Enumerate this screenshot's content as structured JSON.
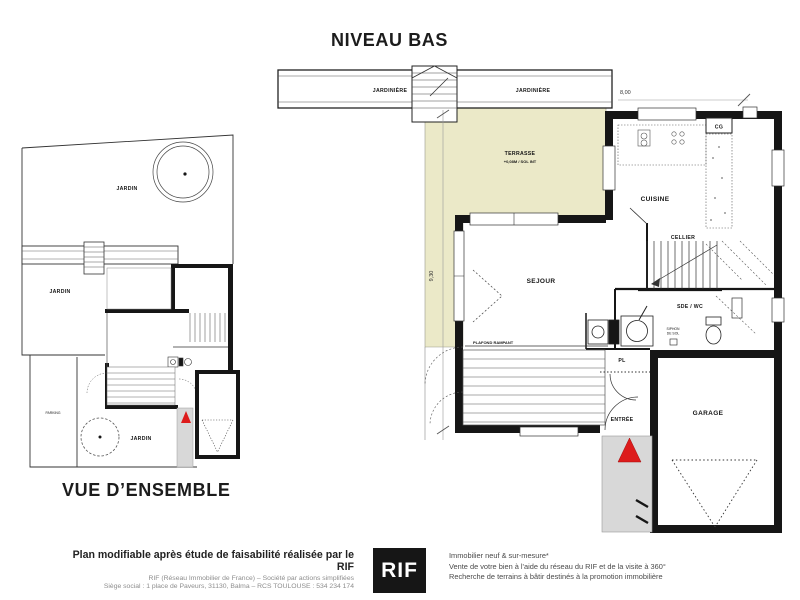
{
  "page": {
    "main_title": "NIVEAU BAS",
    "overview_title": "VUE D’ENSEMBLE"
  },
  "main_plan": {
    "jardiniere_left": "JARDINIÈRE",
    "jardiniere_right": "JARDINIÈRE",
    "dim_width": "8,00",
    "dim_height": "9,30",
    "terrasse": "TERRASSE",
    "terrasse_note": "+0,08M / SOL INT",
    "sejour": "SEJOUR",
    "cuisine": "CUISINE",
    "cellier": "CELLIER",
    "cg": "CG",
    "sde_wc": "SDE / WC",
    "siphon_1": "SIPHON",
    "siphon_2": "DE SOL",
    "pl": "PL",
    "plafond_rampant": "PLAFOND RAMPANT",
    "entree": "ENTRÉE",
    "garage": "GARAGE"
  },
  "overview_plan": {
    "jardin_top": "JARDIN",
    "jardin_mid": "JARDIN",
    "jardin_bottom": "JARDIN",
    "parking": "PARKING"
  },
  "footer": {
    "left_line1": "Plan modifiable après étude de faisabilité réalisée par le RIF",
    "left_line2": "RIF (Réseau Immobilier de France) – Société par actions simplifiées",
    "left_line3": "Siège social : 1 place de Paveurs, 31130, Balma – RCS TOULOUSE : 534 234 174",
    "logo_text": "RIF",
    "right_line1": "Immobilier neuf & sur-mesure*",
    "right_line2": "Vente de votre bien à l'aide du réseau du RIF et de la visite à 360°",
    "right_line3": "Recherche de terrains à bâtir destinés à la promotion immobilière"
  },
  "colors": {
    "terrace_fill": "#ebe9c8",
    "porch_fill": "#d8d8d8",
    "accent_red": "#dd1b1b",
    "wall_dark": "#161616"
  }
}
